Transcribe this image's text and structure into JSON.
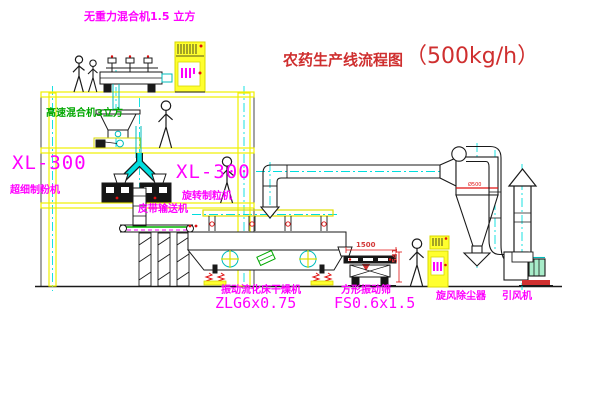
{
  "title": {
    "text": "农药生产线流程图",
    "capacity": "（500kg/h）"
  },
  "labels": {
    "gravity_mixer": "无重力混合机1.5 立方",
    "high_speed_mixer": "高速混合机3立方",
    "mill_model_left": "XL-300",
    "mill_name_left": "超细制粉机",
    "granulator_model": "XL-300",
    "granulator_name": "旋转制粒机",
    "belt_conveyor": "皮带输送机",
    "dryer_name": "振动流化床干燥机",
    "dryer_model": "ZLG6x0.75",
    "sieve_name": "方形振动筛",
    "sieve_model": "FS0.6x1.5",
    "cyclone": "旋风除尘器",
    "fan": "引风机",
    "dim_length": "1500",
    "dim_height": "541"
  },
  "colors": {
    "label_magenta": "#ff00ff",
    "title_red": "#cf2f2f",
    "structure_yellow": "#f0f000",
    "centerline_cyan": "#00dede",
    "accent_green": "#00a800",
    "dimension_red": "#e01010"
  }
}
